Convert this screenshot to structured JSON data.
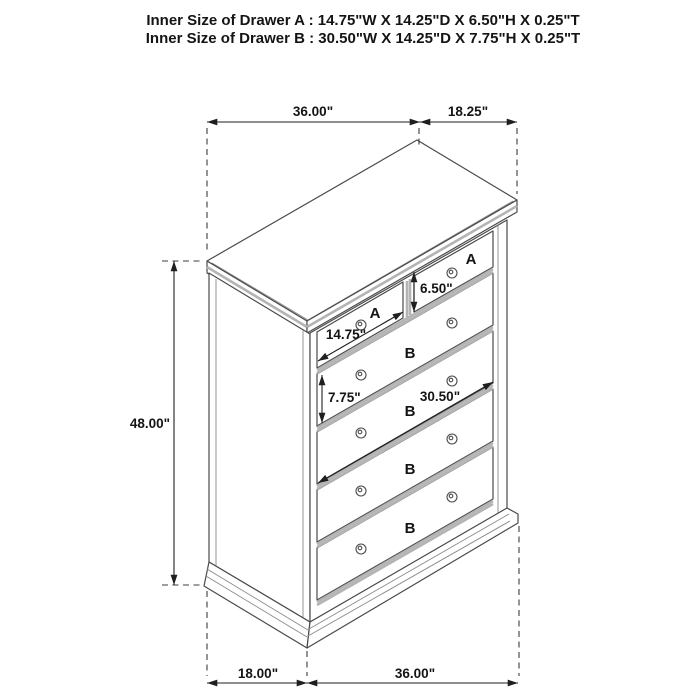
{
  "header": {
    "drawer_a_spec": "Inner Size of Drawer A : 14.75\"W X 14.25\"D X 6.50\"H X 0.25\"T",
    "drawer_b_spec": "Inner Size of Drawer B : 30.50\"W X 14.25\"D X 7.75\"H X 0.25\"T"
  },
  "dimensions": {
    "top_width": "36.00\"",
    "top_depth": "18.25\"",
    "overall_height": "48.00\"",
    "drawer_a_inner_height": "6.50\"",
    "drawer_a_inner_width": "14.75\"",
    "drawer_b_inner_height": "7.75\"",
    "drawer_b_inner_width": "30.50\"",
    "bottom_depth": "18.00\"",
    "bottom_width": "36.00\""
  },
  "drawer_labels": {
    "a_left": "A",
    "a_right": "A",
    "b_1": "B",
    "b_2": "B",
    "b_3": "B",
    "b_4": "B"
  },
  "colors": {
    "label_red": "#f40000",
    "outline_gray": "#4a4a4a",
    "bevel_gray": "#b4b4b4",
    "dimension_black": "#1f1f1f",
    "background": "#ffffff"
  }
}
